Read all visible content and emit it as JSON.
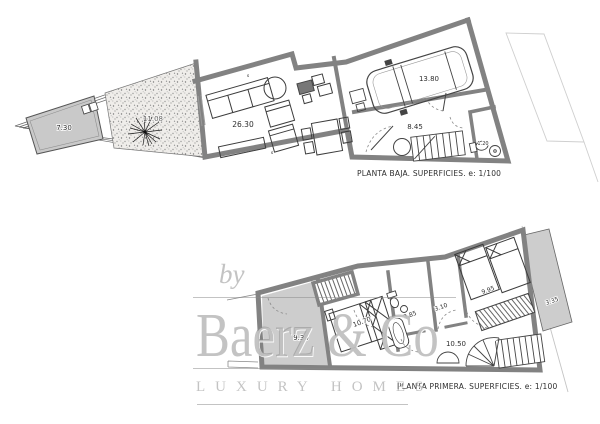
{
  "watermark": {
    "prefix": "by",
    "brand": "Baerz & Co",
    "tagline": "LUXURY HOMES"
  },
  "ground_floor": {
    "caption": "PLANTA BAJA. SUPERFICIES. e: 1/100",
    "rooms": {
      "pool": "7.30",
      "terrace": "11.08",
      "living_room": "26.30",
      "garage": "13.80",
      "hall": "8.45",
      "wc": "1.20"
    },
    "marks": {
      "m1": "s",
      "m2": "s"
    }
  },
  "first_floor": {
    "caption": "PLANTA PRIMERA. SUPERFICIES. e: 1/100",
    "rooms": {
      "terrace": "9.30",
      "bedroom_1": "10.70",
      "bathroom": "3.85",
      "dressing": "3.10",
      "landing": "10.50",
      "bedroom_2": "9.95",
      "balcony": "3.35"
    }
  },
  "colors": {
    "wall": "#828282",
    "paving": "#cdcdcd",
    "ink": "#3c3c3c",
    "watermark": "#969696"
  }
}
